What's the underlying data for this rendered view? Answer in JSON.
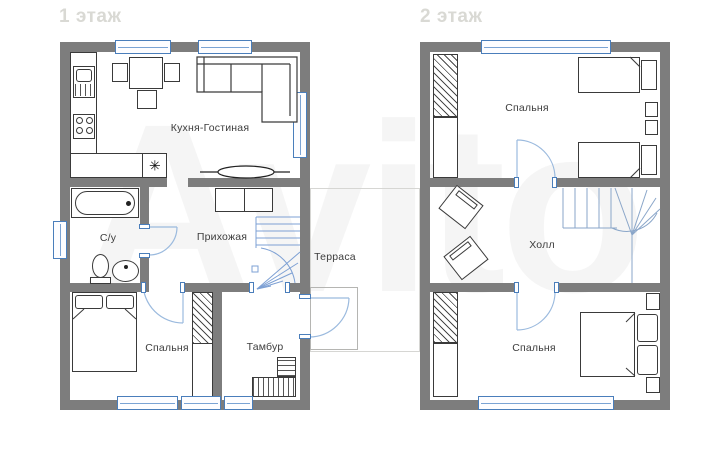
{
  "page": {
    "watermark": "Avito",
    "background": "#ffffff"
  },
  "colors": {
    "wall": "#7d7d7d",
    "window_frame": "#4a7ebb",
    "door_arc": "#9bbade",
    "stairs_line": "#7da0d4",
    "furniture_line": "#3a3a3a",
    "label_text": "#3d3d3d",
    "floor_title": "#d9d9d4"
  },
  "floor1": {
    "title": "1 этаж",
    "fridge_symbol": "✳",
    "rooms": {
      "kitchen_living": "Кухня-Гостиная",
      "bathroom": "С/у",
      "hallway": "Прихожая",
      "terrace": "Терраса",
      "bedroom": "Спальня",
      "vestibule": "Тамбур"
    }
  },
  "floor2": {
    "title": "2 этаж",
    "rooms": {
      "bedroom_top": "Спальня",
      "hall": "Холл",
      "bedroom_bottom": "Спальня"
    }
  }
}
